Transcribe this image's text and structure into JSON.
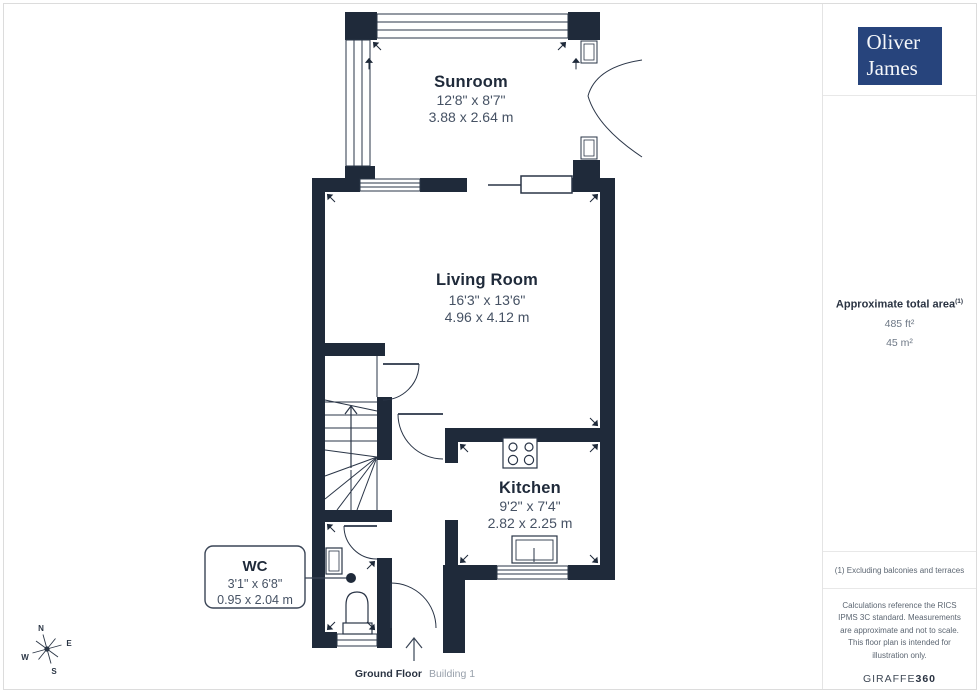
{
  "branding": {
    "logo_line1": "Oliver",
    "logo_line2": "James",
    "logo_bg": "#27447c"
  },
  "sidebar": {
    "area": {
      "label": "Approximate total area",
      "footnote_marker": "(1)",
      "imperial": "485 ft²",
      "metric": "45 m²"
    },
    "footnote": "(1) Excluding balconies and terraces",
    "disclaimer": "Calculations reference the RICS IPMS 3C standard. Measurements are approximate and not to scale. This floor plan is intended for illustration only.",
    "provider": {
      "name_regular": "GIRAFFE",
      "name_bold": "360"
    }
  },
  "floor": {
    "label": "Ground Floor",
    "building": "Building 1"
  },
  "compass": {
    "n": "N",
    "e": "E",
    "s": "S",
    "w": "W"
  },
  "rooms": {
    "sunroom": {
      "name": "Sunroom",
      "imperial": "12'8\" x 8'7\"",
      "metric": "3.88 x 2.64 m"
    },
    "livingroom": {
      "name": "Living Room",
      "imperial": "16'3\" x 13'6\"",
      "metric": "4.96 x 4.12 m"
    },
    "kitchen": {
      "name": "Kitchen",
      "imperial": "9'2\" x 7'4\"",
      "metric": "2.82 x 2.25 m"
    },
    "wc": {
      "name": "WC",
      "imperial": "3'1\" x 6'8\"",
      "metric": "0.95 x 2.04 m"
    }
  },
  "colors": {
    "wall": "#1f2a3a",
    "line": "#2a3547",
    "dim_text": "#465264",
    "logo_navy": "#27447c"
  }
}
